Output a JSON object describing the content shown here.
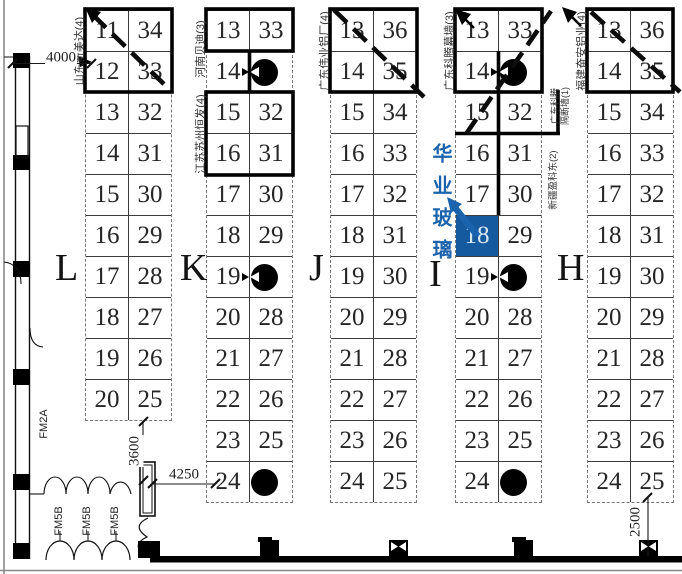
{
  "colors": {
    "highlight_fill": "#15599e",
    "highlight_text": "#d8e7f6",
    "callout_blue": "#1b63ac",
    "line": "#1a1a1a"
  },
  "zones": [
    {
      "letter": "L",
      "rows": [
        [
          "11",
          "34"
        ],
        [
          "12",
          "33"
        ],
        [
          "13",
          "32"
        ],
        [
          "14",
          "31"
        ],
        [
          "15",
          "30"
        ],
        [
          "16",
          "29"
        ],
        [
          "17",
          "28"
        ],
        [
          "18",
          "27"
        ],
        [
          "19",
          "26"
        ],
        [
          "20",
          "25"
        ]
      ],
      "pillar_rows": [],
      "pillar_marks": [],
      "highlight": null
    },
    {
      "letter": "K",
      "rows": [
        [
          "13",
          "33"
        ],
        [
          "14",
          ""
        ],
        [
          "15",
          "32"
        ],
        [
          "16",
          "31"
        ],
        [
          "17",
          "30"
        ],
        [
          "18",
          "29"
        ],
        [
          "19",
          ""
        ],
        [
          "20",
          "28"
        ],
        [
          "21",
          "27"
        ],
        [
          "22",
          "26"
        ],
        [
          "23",
          "25"
        ],
        [
          "24",
          ""
        ]
      ],
      "pillar_rows": [
        1,
        6,
        11
      ],
      "pillar_marks": [
        1,
        6
      ],
      "highlight": null
    },
    {
      "letter": "J",
      "rows": [
        [
          "13",
          "36"
        ],
        [
          "14",
          "35"
        ],
        [
          "15",
          "34"
        ],
        [
          "16",
          "33"
        ],
        [
          "17",
          "32"
        ],
        [
          "18",
          "31"
        ],
        [
          "19",
          "30"
        ],
        [
          "20",
          "29"
        ],
        [
          "21",
          "28"
        ],
        [
          "22",
          "27"
        ],
        [
          "23",
          "26"
        ],
        [
          "24",
          "25"
        ]
      ],
      "pillar_rows": [],
      "pillar_marks": [],
      "highlight": null
    },
    {
      "letter": "I",
      "rows": [
        [
          "13",
          "33"
        ],
        [
          "14",
          ""
        ],
        [
          "15",
          "32"
        ],
        [
          "16",
          "31"
        ],
        [
          "17",
          "30"
        ],
        [
          "18",
          "29"
        ],
        [
          "19",
          ""
        ],
        [
          "20",
          "28"
        ],
        [
          "21",
          "27"
        ],
        [
          "22",
          "26"
        ],
        [
          "23",
          "25"
        ],
        [
          "24",
          ""
        ]
      ],
      "pillar_rows": [
        1,
        6,
        11
      ],
      "pillar_marks": [
        1,
        6
      ],
      "highlight": {
        "row": 5,
        "col": 0,
        "booth": "18"
      }
    },
    {
      "letter": "H",
      "rows": [
        [
          "13",
          "36"
        ],
        [
          "14",
          "35"
        ],
        [
          "15",
          "34"
        ],
        [
          "16",
          "33"
        ],
        [
          "17",
          "32"
        ],
        [
          "18",
          "31"
        ],
        [
          "19",
          "30"
        ],
        [
          "20",
          "29"
        ],
        [
          "21",
          "28"
        ],
        [
          "22",
          "27"
        ],
        [
          "23",
          "26"
        ],
        [
          "24",
          "25"
        ]
      ],
      "pillar_rows": [],
      "pillar_marks": [],
      "highlight": null
    }
  ],
  "labels": {
    "l_top": "山东新美达(4)",
    "k_top": "河南贝迪(3)",
    "k_mid": "江苏苏州恒发(4)",
    "j_top": "广东伟业铝厂(4)",
    "i_top": "广东科腾幕墙(3)",
    "i_side_line1": "广东科腾",
    "i_side_line2": "隔断墙(1)",
    "i_side2": "新疆盈科东(2)",
    "h_top": "福建奋安铝业(4)"
  },
  "dimensions": {
    "d4000": "4000",
    "d3600": "3600",
    "d4250": "4250",
    "d2500": "2500"
  },
  "doors": {
    "fm2a": "FM2A",
    "fm5b": "FM5B"
  },
  "callout": {
    "text": "华业玻璃",
    "target_booth": "18"
  }
}
